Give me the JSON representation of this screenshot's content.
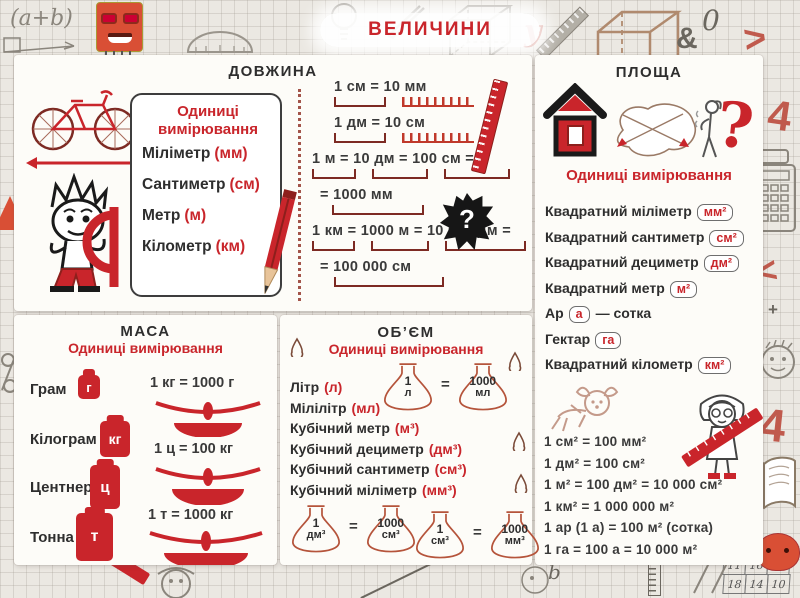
{
  "title": "ВЕЛИЧИНИ",
  "length": {
    "heading": "ДОВЖИНА",
    "box_title": "Одиниці вимірювання",
    "units": [
      {
        "name": "Міліметр",
        "abbr": "(мм)"
      },
      {
        "name": "Сантиметр",
        "abbr": "(см)"
      },
      {
        "name": "Метр",
        "abbr": "(м)"
      },
      {
        "name": "Кілометр",
        "abbr": "(км)"
      }
    ],
    "conversions": [
      "1 см = 10 мм",
      "1 дм = 10 см",
      "1 м = 10 дм = 100 см =",
      "= 1000 мм",
      "1 км = 1000 м = 10 000 дм =",
      "= 100 000 см"
    ],
    "mystery_mark": "?"
  },
  "area": {
    "heading": "ПЛОЩА",
    "subtitle": "Одиниці вимірювання",
    "question_mark": "?",
    "units": [
      {
        "name": "Квадратний  міліметр",
        "badge": "мм²",
        "suffix": ""
      },
      {
        "name": "Квадратний  сантиметр",
        "badge": "см²",
        "suffix": ""
      },
      {
        "name": "Квадратний  дециметр",
        "badge": "дм²",
        "suffix": ""
      },
      {
        "name": "Квадратний  метр",
        "badge": "м²",
        "suffix": ""
      },
      {
        "name": "Ар",
        "badge": "а",
        "suffix": "—  сотка"
      },
      {
        "name": "Гектар",
        "badge": "га",
        "suffix": ""
      },
      {
        "name": "Квадратний  кілометр",
        "badge": "км²",
        "suffix": ""
      }
    ],
    "conversions": [
      "1 см² = 100 мм²",
      "1 дм² = 100 см²",
      "1 м² = 100 дм² = 10 000 см²",
      "1 км² = 1 000 000 м²",
      "1 ар (1 а) = 100 м² (сотка)",
      "1 га = 100 а = 10 000 м²"
    ]
  },
  "mass": {
    "heading": "МАСА",
    "subtitle": "Одиниці вимірювання",
    "units": [
      {
        "name": "Грам",
        "abbr": "г"
      },
      {
        "name": "Кілограм",
        "abbr": "кг"
      },
      {
        "name": "Центнер",
        "abbr": "ц"
      },
      {
        "name": "Тонна",
        "abbr": "т"
      }
    ],
    "equations": [
      "1 кг = 1000 г",
      "1 ц = 100 кг",
      "1 т = 1000 кг"
    ]
  },
  "volume": {
    "heading": "ОБ’ЄМ",
    "subtitle": "Одиниці вимірювання",
    "units": [
      {
        "name": "Літр",
        "abbr": "(л)"
      },
      {
        "name": "Мілілітр",
        "abbr": "(мл)"
      },
      {
        "name": "Кубічний  метр",
        "abbr": "(м³)"
      },
      {
        "name": "Кубічний  дециметр",
        "abbr": "(дм³)"
      },
      {
        "name": "Кубічний  сантиметр",
        "abbr": "(см³)"
      },
      {
        "name": "Кубічний  міліметр",
        "abbr": "(мм³)"
      }
    ],
    "flasks": [
      {
        "a_top": "1",
        "a_unit": "л",
        "eq": "=",
        "b_top": "1000",
        "b_unit": "мл"
      },
      {
        "a_top": "1",
        "a_unit": "дм³",
        "eq": "=",
        "b_top": "1000",
        "b_unit": "см³"
      },
      {
        "a_top": "1",
        "a_unit": "см³",
        "eq": "=",
        "b_top": "1000",
        "b_unit": "мм³"
      }
    ]
  },
  "doodles": {
    "formula": "(a+b)",
    "letter_y": "y",
    "ampersand": "&",
    "zero": "0",
    "gt": ">",
    "lt": "<",
    "x_plus": "X +",
    "four_top": "4",
    "four_bottom": "4",
    "letter_b": "b",
    "grid_numbers": [
      "11",
      "16",
      "15",
      "18",
      "14",
      "10"
    ]
  },
  "colors": {
    "accent_red": "#c9252b",
    "text_dark": "#333333",
    "paper": "#ebe8e2",
    "panel": "#fdfcf8"
  }
}
